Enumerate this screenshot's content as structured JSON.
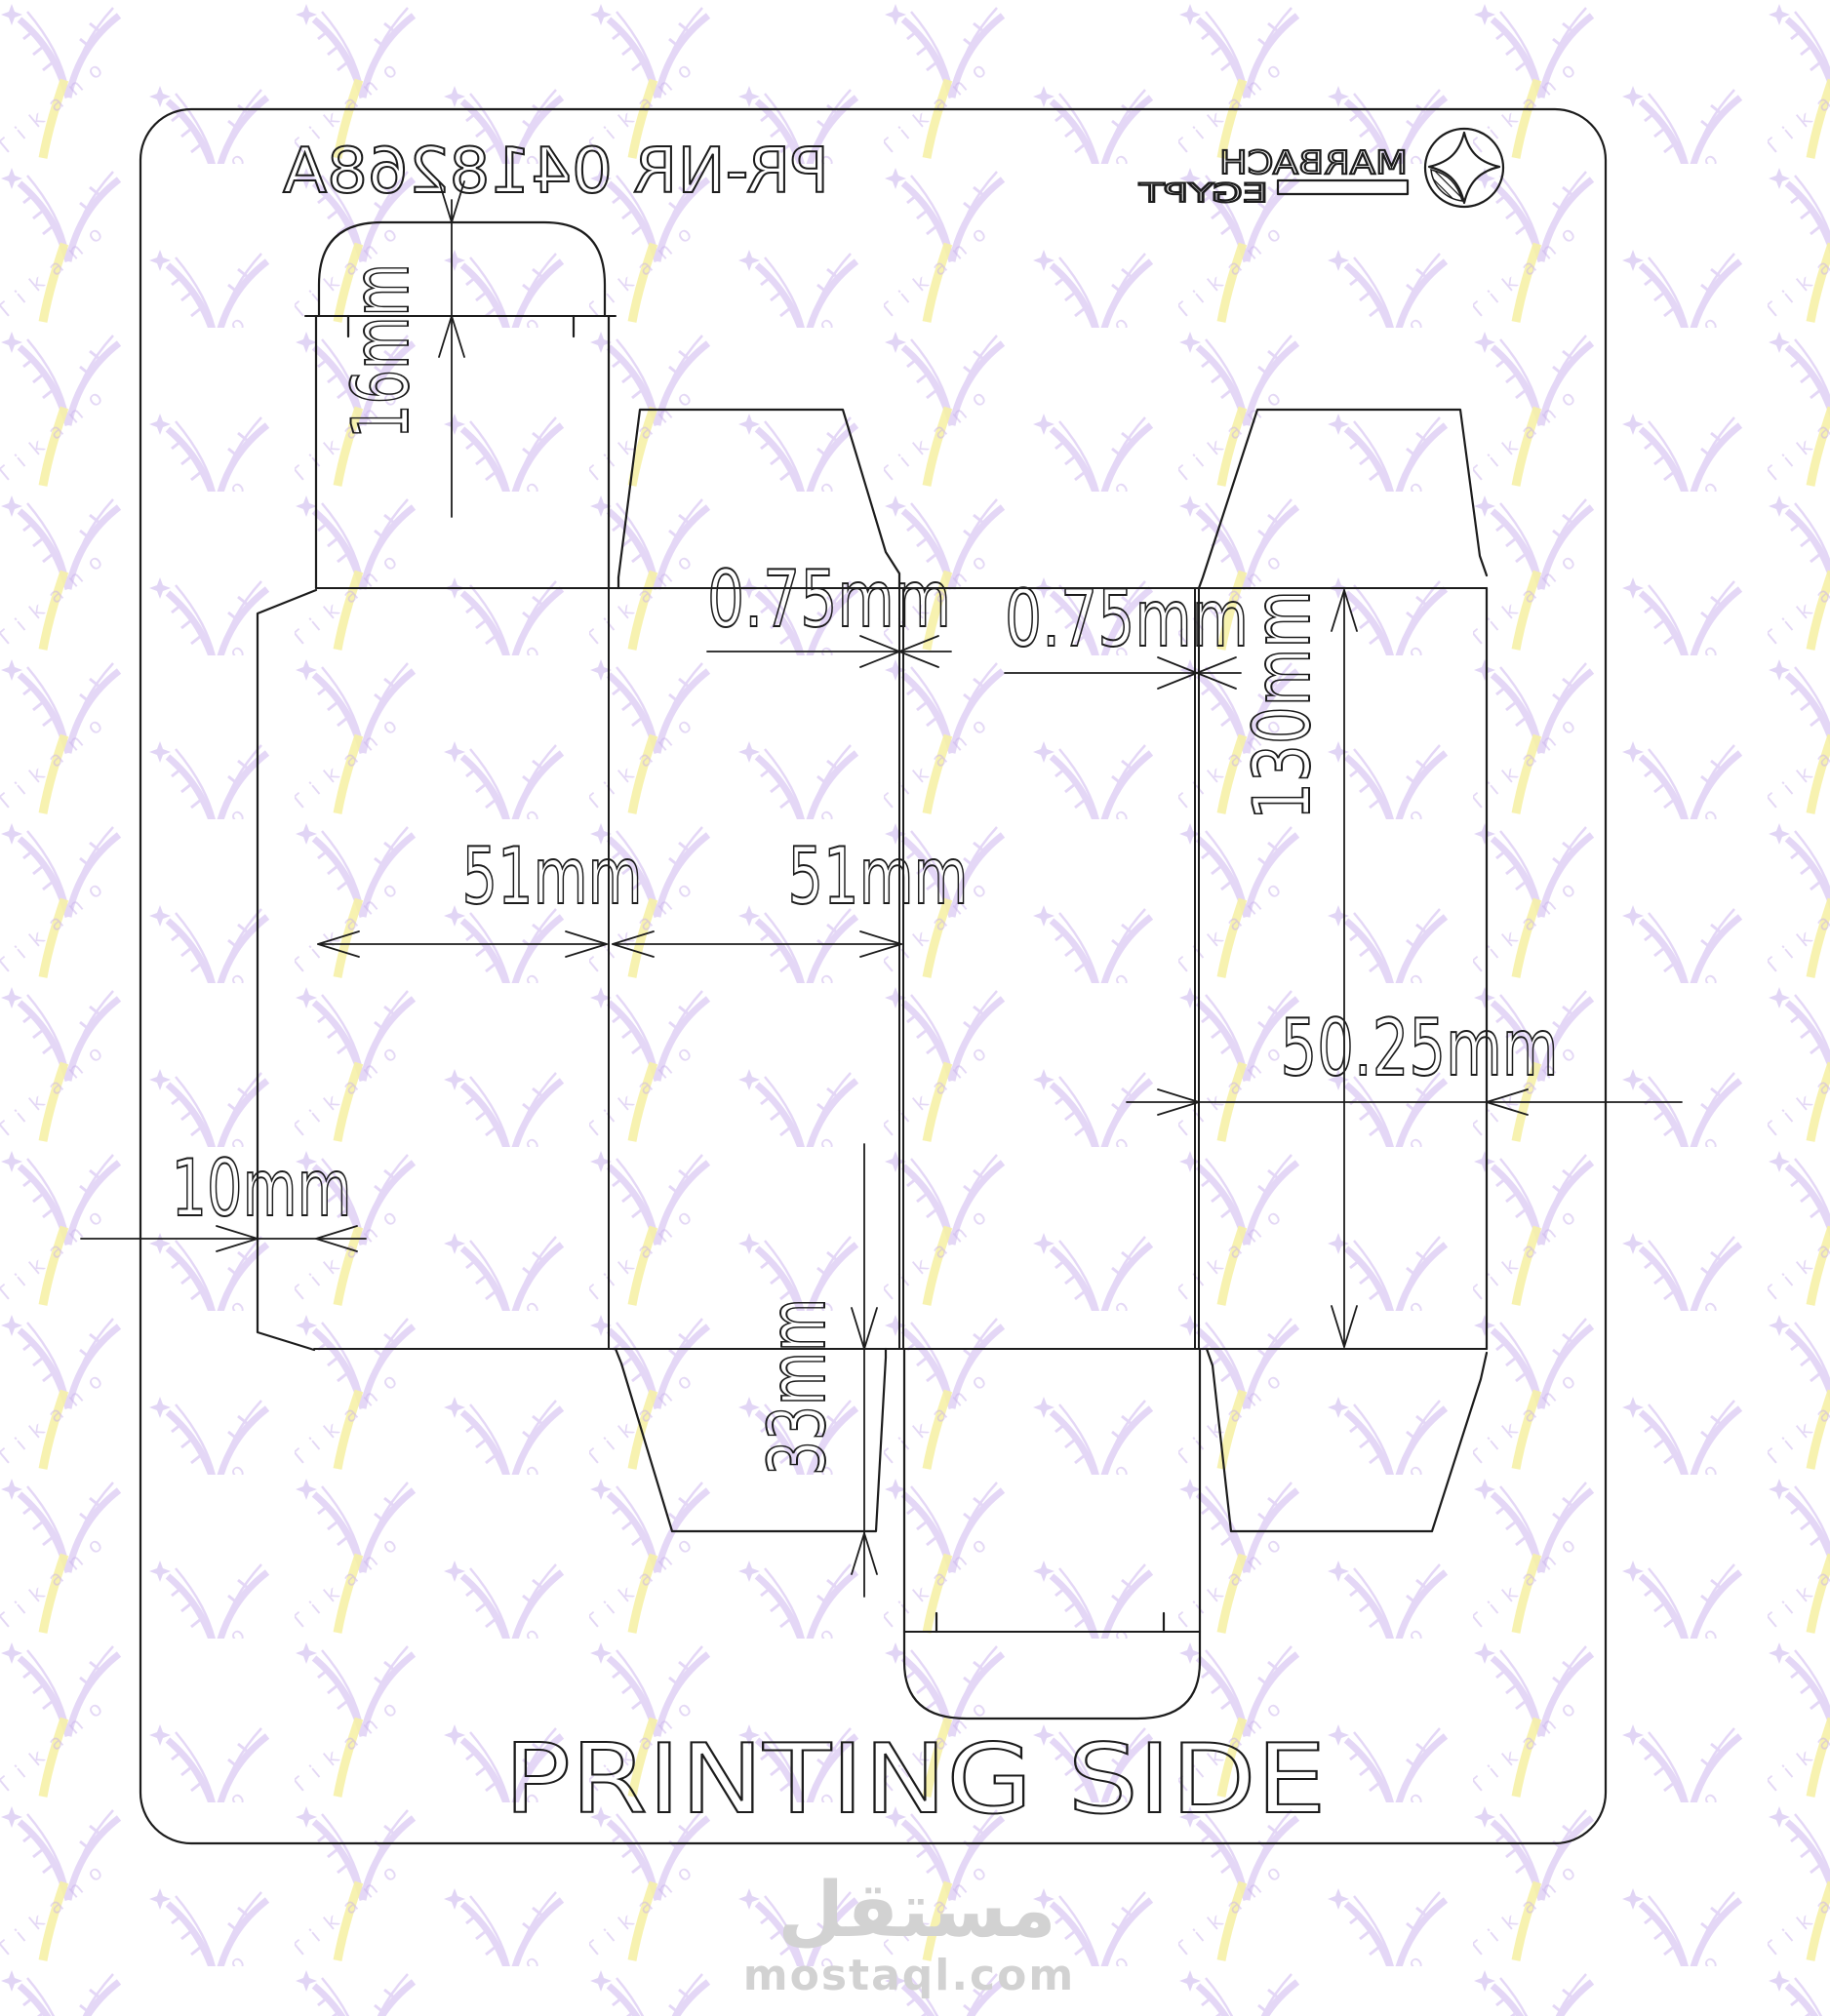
{
  "header": {
    "part_number": "PR-NR 0418268A",
    "logo_brand": "MARBACH",
    "logo_region": "EGYPT"
  },
  "footer": {
    "printing_side": "PRINTING SIDE"
  },
  "dimensions": {
    "tuck_flap_height": "16mm",
    "gap_left": "0.75mm",
    "gap_right": "0.75mm",
    "box_height": "130mm",
    "front_panel_width": "51mm",
    "side_panel_width": "51mm",
    "depth_panel_width": "50.25mm",
    "glue_flap_width": "10mm",
    "dust_flap_height": "33mm"
  },
  "watermarks": {
    "pattern_text": "Tikano",
    "site_name": "مستقل",
    "site_url": "mostaql.com"
  },
  "colors": {
    "line": "#1c1c1c",
    "watermark_purple": "#cbb5ec",
    "watermark_yellow": "#f6f0a6",
    "watermark_gray": "#d2d2d2"
  }
}
